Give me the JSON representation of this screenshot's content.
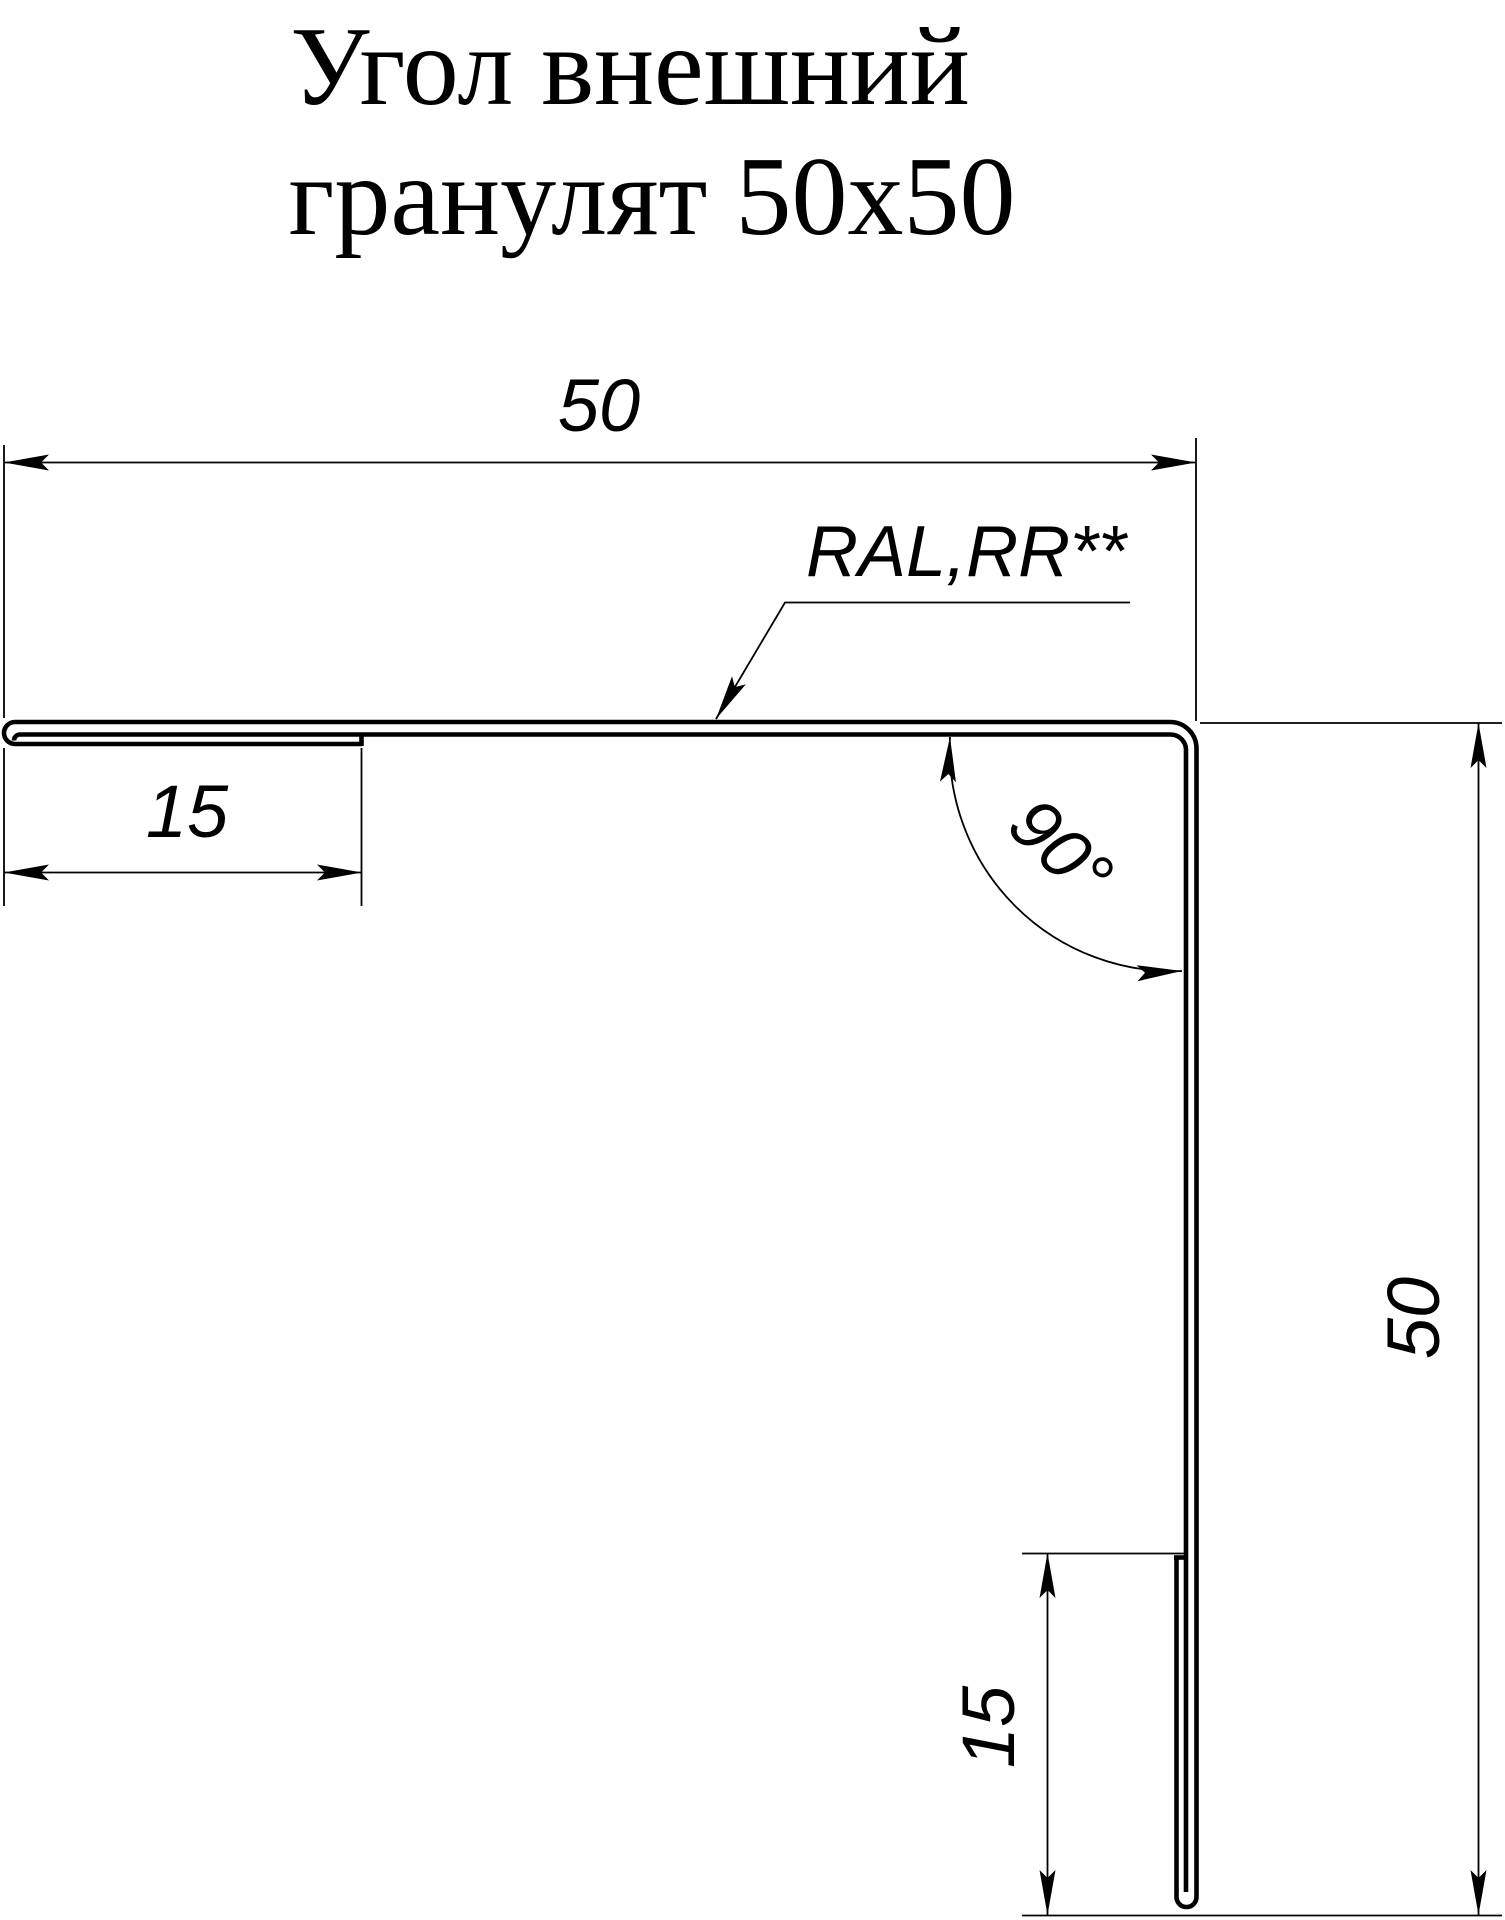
{
  "canvas": {
    "background": "#ffffff",
    "ink": "#000000"
  },
  "title": {
    "line1": "Угол внешний",
    "line2": "гранулят 50х50"
  },
  "annotations": {
    "coating": "RAL,RR**",
    "angle": "90°"
  },
  "dimensions": {
    "top_width": "50",
    "left_hem": "15",
    "right_height": "50",
    "bottom_hem": "15"
  }
}
